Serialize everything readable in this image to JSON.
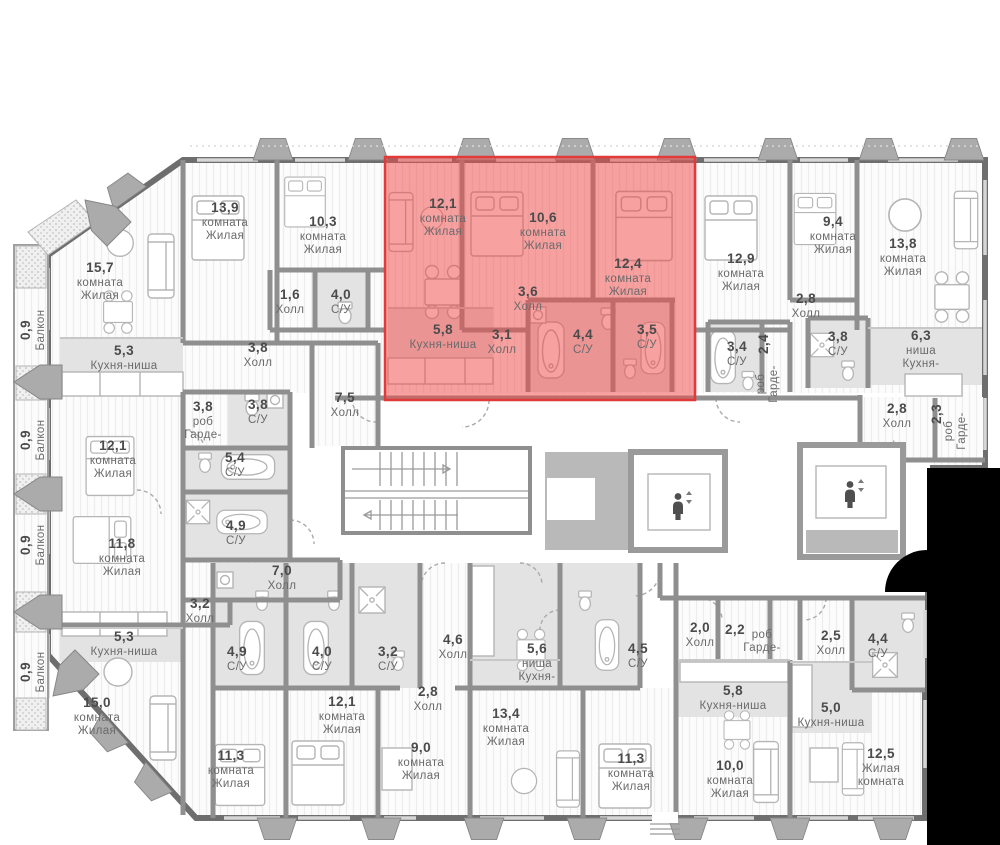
{
  "colors": {
    "apartment_highlight_fill": "#ef4b4b",
    "apartment_highlight_border": "#e03a3a",
    "cutout": "#000000",
    "wet_zone_fill": "#e3e3e3",
    "wall": "#8f8f8f"
  },
  "floor_plan": {
    "rooms": [
      {
        "name": "room-13-9",
        "area": "13,9",
        "lines": [
          "комната",
          "Жилая"
        ],
        "x": 225,
        "y": 212
      },
      {
        "name": "room-10-3",
        "area": "10,3",
        "lines": [
          "комната",
          "Жилая"
        ],
        "x": 323,
        "y": 226
      },
      {
        "name": "room-15-7",
        "area": "15,7",
        "lines": [
          "комната",
          "Жилая"
        ],
        "x": 100,
        "y": 272
      },
      {
        "name": "kitchen-5-3-top",
        "area": "5,3",
        "lines": [
          "Кухня-ниша"
        ],
        "x": 124,
        "y": 355
      },
      {
        "name": "hall-1-6",
        "area": "1,6",
        "lines": [
          "Холл"
        ],
        "x": 290,
        "y": 299
      },
      {
        "name": "bath-4-0-top",
        "area": "4,0",
        "lines": [
          "С/У"
        ],
        "x": 341,
        "y": 299
      },
      {
        "name": "hall-3-8",
        "area": "3,8",
        "lines": [
          "Холл"
        ],
        "x": 258,
        "y": 352
      },
      {
        "name": "wardrobe-3-8",
        "area": "3,8",
        "lines": [
          "роб",
          "Гарде-"
        ],
        "x": 203,
        "y": 411
      },
      {
        "name": "bath-3-8-left",
        "area": "3,8",
        "lines": [
          "С/У"
        ],
        "x": 258,
        "y": 409
      },
      {
        "name": "hall-7-5",
        "area": "7,5",
        "lines": [
          "Холл"
        ],
        "x": 345,
        "y": 402
      },
      {
        "name": "room-12-1-red",
        "area": "12,1",
        "lines": [
          "комната",
          "Жилая"
        ],
        "x": 443,
        "y": 208,
        "highlight": true
      },
      {
        "name": "room-10-6",
        "area": "10,6",
        "lines": [
          "комната",
          "Жилая"
        ],
        "x": 543,
        "y": 222,
        "highlight": true
      },
      {
        "name": "room-12-4",
        "area": "12,4",
        "lines": [
          "комната",
          "Жилая"
        ],
        "x": 628,
        "y": 268,
        "highlight": true
      },
      {
        "name": "hall-3-6",
        "area": "3,6",
        "lines": [
          "Холл"
        ],
        "x": 528,
        "y": 296,
        "highlight": true
      },
      {
        "name": "kitchen-5-8-red",
        "area": "5,8",
        "lines": [
          "Кухня-ниша"
        ],
        "x": 443,
        "y": 334,
        "highlight": true
      },
      {
        "name": "hall-3-1",
        "area": "3,1",
        "lines": [
          "Холл"
        ],
        "x": 502,
        "y": 339,
        "highlight": true
      },
      {
        "name": "bath-4-4-red",
        "area": "4,4",
        "lines": [
          "С/У"
        ],
        "x": 583,
        "y": 339,
        "highlight": true
      },
      {
        "name": "bath-3-5",
        "area": "3,5",
        "lines": [
          "С/У"
        ],
        "x": 647,
        "y": 334,
        "highlight": true
      },
      {
        "name": "room-12-9",
        "area": "12,9",
        "lines": [
          "комната",
          "Жилая"
        ],
        "x": 741,
        "y": 263
      },
      {
        "name": "room-9-4",
        "area": "9,4",
        "lines": [
          "комната",
          "Жилая"
        ],
        "x": 833,
        "y": 226
      },
      {
        "name": "room-13-8",
        "area": "13,8",
        "lines": [
          "комната",
          "Жилая"
        ],
        "x": 903,
        "y": 248
      },
      {
        "name": "hall-2-8-topright",
        "area": "2,8",
        "lines": [
          "Холл"
        ],
        "x": 806,
        "y": 303
      },
      {
        "name": "bath-3-4",
        "area": "3,4",
        "lines": [
          "С/У"
        ],
        "x": 737,
        "y": 351
      },
      {
        "name": "wardrobe-2-4-area",
        "area": "2,4",
        "x": 768,
        "y": 344,
        "rot": -90
      },
      {
        "name": "wardrobe-2-4-label",
        "lines": [
          "роб",
          "Гарде-"
        ],
        "x": 764,
        "y": 384,
        "rot": -90
      },
      {
        "name": "bath-3-8-right",
        "area": "3,8",
        "lines": [
          "С/У"
        ],
        "x": 838,
        "y": 341
      },
      {
        "name": "kitchen-6-3",
        "area": "6,3",
        "lines": [
          "ниша",
          "Кухня-"
        ],
        "x": 921,
        "y": 340
      },
      {
        "name": "hall-2-8-right",
        "area": "2,8",
        "lines": [
          "Холл"
        ],
        "x": 897,
        "y": 413
      },
      {
        "name": "wardrobe-2-3-area",
        "area": "2,3",
        "x": 941,
        "y": 414,
        "rot": -90
      },
      {
        "name": "wardrobe-2-3-label",
        "lines": [
          "роб",
          "Гарде-"
        ],
        "x": 952,
        "y": 431,
        "rot": -90
      },
      {
        "name": "room-12-1-left",
        "area": "12,1",
        "lines": [
          "комната",
          "Жилая"
        ],
        "x": 113,
        "y": 450
      },
      {
        "name": "bath-5-4",
        "area": "5,4",
        "lines": [
          "С/У"
        ],
        "x": 235,
        "y": 462
      },
      {
        "name": "bath-4-9-left",
        "area": "4,9",
        "lines": [
          "С/У"
        ],
        "x": 236,
        "y": 530
      },
      {
        "name": "room-11-8",
        "area": "11,8",
        "lines": [
          "комната",
          "Жилая"
        ],
        "x": 122,
        "y": 548
      },
      {
        "name": "hall-7-0",
        "area": "7,0",
        "lines": [
          "Холл"
        ],
        "x": 282,
        "y": 575
      },
      {
        "name": "hall-3-2",
        "area": "3,2",
        "lines": [
          "Холл"
        ],
        "x": 200,
        "y": 608
      },
      {
        "name": "kitchen-5-3-bottom",
        "area": "5,3",
        "lines": [
          "Кухня-ниша"
        ],
        "x": 124,
        "y": 641
      },
      {
        "name": "room-15-0",
        "area": "15,0",
        "lines": [
          "комната",
          "Жилая"
        ],
        "x": 97,
        "y": 707
      },
      {
        "name": "balcony-1",
        "area": "0,9",
        "lines": [
          "Балкон"
        ],
        "x": 30,
        "y": 330,
        "rot": -90
      },
      {
        "name": "balcony-2",
        "area": "0,9",
        "lines": [
          "Балкон"
        ],
        "x": 30,
        "y": 440,
        "rot": -90
      },
      {
        "name": "balcony-3",
        "area": "0,9",
        "lines": [
          "Балкон"
        ],
        "x": 30,
        "y": 545,
        "rot": -90
      },
      {
        "name": "balcony-4",
        "area": "0,9",
        "lines": [
          "Балкон"
        ],
        "x": 30,
        "y": 672,
        "rot": -90
      },
      {
        "name": "bath-4-9-bottom",
        "area": "4,9",
        "lines": [
          "С/У"
        ],
        "x": 237,
        "y": 656
      },
      {
        "name": "bath-4-0-bottom",
        "area": "4,0",
        "lines": [
          "С/У"
        ],
        "x": 322,
        "y": 656
      },
      {
        "name": "bath-3-2",
        "area": "3,2",
        "lines": [
          "С/У"
        ],
        "x": 388,
        "y": 656
      },
      {
        "name": "hall-4-6",
        "area": "4,6",
        "lines": [
          "Холл"
        ],
        "x": 453,
        "y": 644
      },
      {
        "name": "hall-2-8-bottom",
        "area": "2,8",
        "lines": [
          "Холл"
        ],
        "x": 428,
        "y": 696
      },
      {
        "name": "room-12-1-bottom",
        "area": "12,1",
        "lines": [
          "комната",
          "Жилая"
        ],
        "x": 342,
        "y": 706
      },
      {
        "name": "room-11-3-bottomleft",
        "area": "11,3",
        "lines": [
          "комната",
          "Жилая"
        ],
        "x": 231,
        "y": 760
      },
      {
        "name": "room-9-0",
        "area": "9,0",
        "lines": [
          "комната",
          "Жилая"
        ],
        "x": 421,
        "y": 752
      },
      {
        "name": "room-13-4",
        "area": "13,4",
        "lines": [
          "комната",
          "Жилая"
        ],
        "x": 506,
        "y": 718
      },
      {
        "name": "kitchen-5-6",
        "area": "5,6",
        "lines": [
          "ниша",
          "Кухня-"
        ],
        "x": 537,
        "y": 653
      },
      {
        "name": "bath-4-5",
        "area": "4,5",
        "lines": [
          "С/У"
        ],
        "x": 638,
        "y": 653
      },
      {
        "name": "room-11-3-bottommid",
        "area": "11,3",
        "lines": [
          "комната",
          "Жилая"
        ],
        "x": 631,
        "y": 763
      },
      {
        "name": "hall-2-0",
        "area": "2,0",
        "lines": [
          "Холл"
        ],
        "x": 700,
        "y": 632
      },
      {
        "name": "wardrobe-2-2-area",
        "area": "2,2",
        "x": 735,
        "y": 634
      },
      {
        "name": "wardrobe-2-2-label",
        "lines": [
          "роб",
          "Гарде-"
        ],
        "x": 762,
        "y": 638
      },
      {
        "name": "hall-2-5",
        "area": "2,5",
        "lines": [
          "Холл"
        ],
        "x": 831,
        "y": 640
      },
      {
        "name": "bath-4-4-bottom",
        "area": "4,4",
        "lines": [
          "С/У"
        ],
        "x": 878,
        "y": 643
      },
      {
        "name": "kitchen-5-8-bottom",
        "area": "5,8",
        "lines": [
          "Кухня-ниша"
        ],
        "x": 733,
        "y": 695
      },
      {
        "name": "kitchen-5-0",
        "area": "5,0",
        "lines": [
          "Кухня-ниша"
        ],
        "x": 831,
        "y": 712
      },
      {
        "name": "room-10-0",
        "area": "10,0",
        "lines": [
          "комната",
          "Жилая"
        ],
        "x": 730,
        "y": 770
      },
      {
        "name": "room-12-5",
        "area": "12,5",
        "lines": [
          "Жилая",
          "комната"
        ],
        "x": 881,
        "y": 758
      }
    ],
    "elevators": [
      {
        "name": "elevator-left",
        "x": 678,
        "y": 504
      },
      {
        "name": "elevator-right",
        "x": 850,
        "y": 492
      }
    ]
  }
}
